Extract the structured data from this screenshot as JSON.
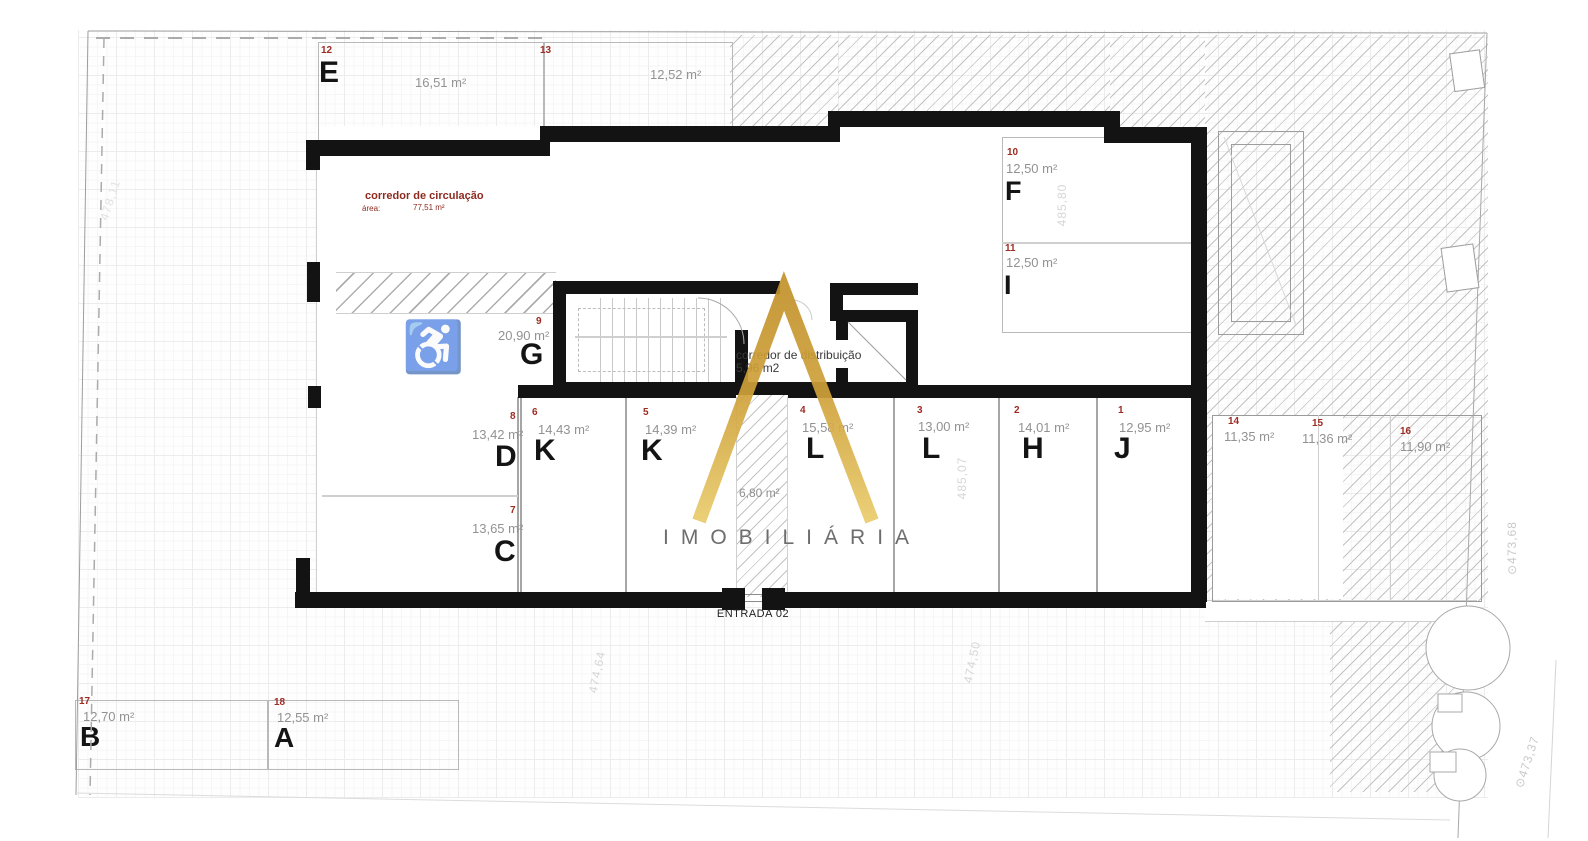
{
  "plan_title": "floor plan - garage / parking level",
  "colors": {
    "wall": "#131313",
    "unit_number_red": "#9e2b22",
    "letter_black": "#141414",
    "area_gray": "#929292",
    "corridor_red": "#8e2a1f",
    "gold_dark": "#b5841f",
    "gold_light": "#e9cb6b",
    "accessibility_teal": "#6ec3b9",
    "elevation_gray": "#d6d6d6"
  },
  "units": [
    {
      "number": "12",
      "letter": "E",
      "area": "16,51 m²"
    },
    {
      "number": "13",
      "letter": "",
      "area": "12,52 m²"
    },
    {
      "number": "10",
      "letter": "F",
      "area": "12,50 m²"
    },
    {
      "number": "11",
      "letter": "I",
      "area": "12,50 m²"
    },
    {
      "number": "9",
      "letter": "G",
      "area": "20,90 m²"
    },
    {
      "number": "8",
      "letter": "D",
      "area": "13,42 m²"
    },
    {
      "number": "7",
      "letter": "C",
      "area": "13,65 m²"
    },
    {
      "number": "6",
      "letter": "K",
      "area": "14,43 m²"
    },
    {
      "number": "5",
      "letter": "K",
      "area": "14,39 m²"
    },
    {
      "number": "4",
      "letter": "L",
      "area": "15,58 m²"
    },
    {
      "number": "3",
      "letter": "L",
      "area": "13,00 m²"
    },
    {
      "number": "2",
      "letter": "H",
      "area": "14,01 m²"
    },
    {
      "number": "1",
      "letter": "J",
      "area": "12,95 m²"
    },
    {
      "number": "14",
      "letter": "",
      "area": "11,35 m²"
    },
    {
      "number": "15",
      "letter": "",
      "area": "11,36 m²"
    },
    {
      "number": "16",
      "letter": "",
      "area": "11,90 m²"
    },
    {
      "number": "17",
      "letter": "B",
      "area": "12,70 m²"
    },
    {
      "number": "18",
      "letter": "A",
      "area": "12,55 m²"
    }
  ],
  "corridors": {
    "circulation": {
      "title": "corredor de circulação",
      "area_label": "área:",
      "area_value": "77,51 m²"
    },
    "distribution": {
      "line1": "corredor de distribuição",
      "line2": "5,96 m2"
    },
    "entrance_hall_area": "6,80 m²"
  },
  "entrance": {
    "label": "ENTRADA 02"
  },
  "watermark": {
    "brand": "IMOBILIÁRIA"
  },
  "icons": {
    "accessibility": "♿"
  },
  "elevations": [
    "485,80",
    "485,07",
    "474,64",
    "474,50",
    "⊙473,68",
    "⊙473,37",
    "478,11"
  ]
}
